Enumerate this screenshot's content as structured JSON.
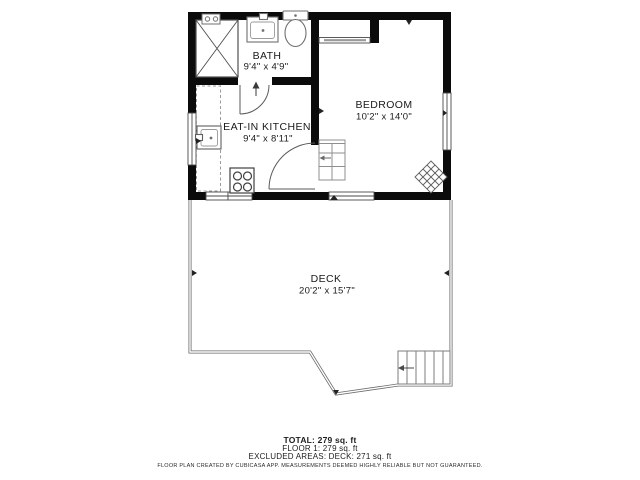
{
  "floorplan": {
    "rooms": [
      {
        "name": "BATH",
        "dims": "9'4\" x 4'9\""
      },
      {
        "name": "BEDROOM",
        "dims": "10'2\" x 14'0\""
      },
      {
        "name": "EAT-IN KITCHEN",
        "dims": "9'4\" x 8'11\""
      },
      {
        "name": "DECK",
        "dims": "20'2\" x 15'7\""
      }
    ],
    "summary": {
      "total": "TOTAL: 279 sq. ft",
      "floor1": "FLOOR 1: 279 sq. ft",
      "excluded": "EXCLUDED AREAS: DECK: 271 sq. ft"
    },
    "disclaimer": "FLOOR PLAN CREATED BY CUBICASA APP. MEASUREMENTS DEEMED HIGHLY RELIABLE BUT NOT GUARANTEED.",
    "colors": {
      "wall": "#0b0b0b",
      "fixture_line": "#6f6f6f",
      "stair_line": "#8f8f8f",
      "deck_line": "#6a6a6a",
      "text": "#1c1c1c"
    }
  }
}
